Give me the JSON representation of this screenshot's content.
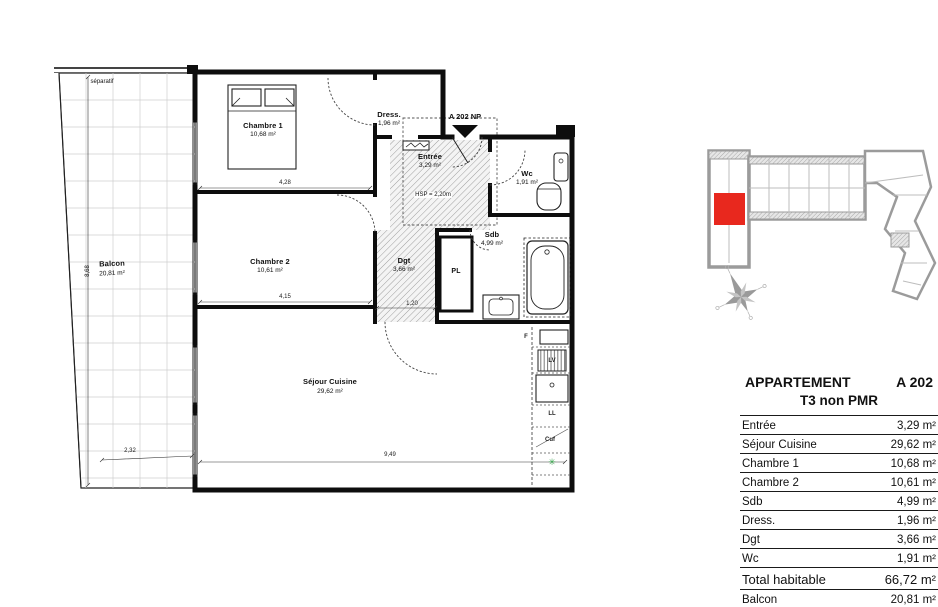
{
  "plan": {
    "separatif": "séparatif",
    "unit_arrow_label": "A 202 NP",
    "hsp_note": "HSP = 2,20m",
    "rooms": {
      "balcon": {
        "name": "Balcon",
        "area": "20,81 m²"
      },
      "chambre1": {
        "name": "Chambre 1",
        "area": "10,68 m²"
      },
      "dress": {
        "name": "Dress.",
        "area": "1,96 m²"
      },
      "entree": {
        "name": "Entrée",
        "area": "3,29 m²"
      },
      "wc": {
        "name": "Wc",
        "area": "1,91 m²"
      },
      "chambre2": {
        "name": "Chambre 2",
        "area": "10,61 m²"
      },
      "dgt": {
        "name": "Dgt",
        "area": "3,66 m²"
      },
      "pl": {
        "name": "PL"
      },
      "sdb": {
        "name": "Sdb",
        "area": "4,99 m²"
      },
      "sejour": {
        "name": "Séjour Cuisine",
        "area": "29,62 m²"
      }
    },
    "kitchen": {
      "fridge": "F",
      "dishwasher": "LV",
      "washing_machine": "LL",
      "cooker": "Cuf",
      "eco_symbol": "✳"
    },
    "dimensions": {
      "chambre1_width": "4,28",
      "chambre2_width": "4,15",
      "sejour_width": "9,49",
      "balcon_width": "2,32",
      "balcon_height": "8,68",
      "dgt_width": "1,20"
    }
  },
  "key_plan": {
    "highlight_color": "#e8281e"
  },
  "table": {
    "title": "APPARTEMENT",
    "unit": "A 202",
    "subtitle": "T3 non PMR",
    "rows": [
      {
        "label": "Entrée",
        "value": "3,29 m²"
      },
      {
        "label": "Séjour Cuisine",
        "value": "29,62 m²"
      },
      {
        "label": "Chambre 1",
        "value": "10,68 m²"
      },
      {
        "label": "Chambre 2",
        "value": "10,61 m²"
      },
      {
        "label": "Sdb",
        "value": "4,99 m²"
      },
      {
        "label": "Dress.",
        "value": "1,96 m²"
      },
      {
        "label": "Dgt",
        "value": "3,66 m²"
      },
      {
        "label": "Wc",
        "value": "1,91 m²"
      },
      {
        "label": "Total habitable",
        "value": "66,72 m²"
      },
      {
        "label": "Balcon",
        "value": "20,81 m²"
      }
    ]
  }
}
